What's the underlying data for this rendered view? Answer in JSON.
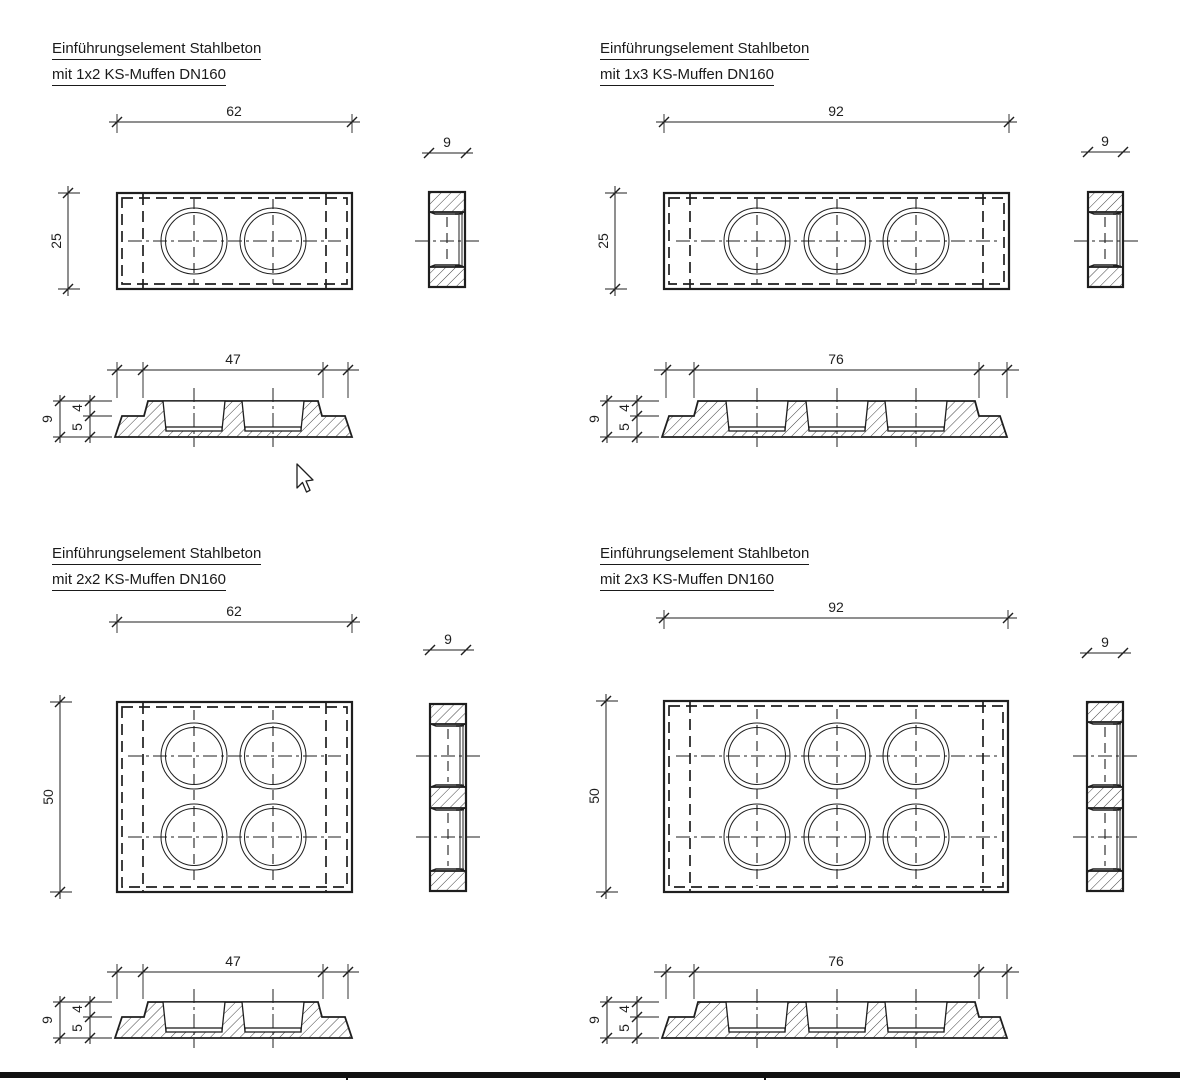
{
  "titles": {
    "tl1": "Einführungselement Stahlbeton",
    "tl2": "mit 1x2 KS-Muffen DN160",
    "tr1": "Einführungselement Stahlbeton",
    "tr2": "mit 1x3 KS-Muffen DN160",
    "bl1": "Einführungselement Stahlbeton",
    "bl2": "mit 2x2 KS-Muffen DN160",
    "br1": "Einführungselement Stahlbeton",
    "br2": "mit 2x3 KS-Muffen DN160"
  },
  "dims": {
    "tl": {
      "plan_w": "62",
      "plan_h": "25",
      "side_w": "9",
      "sec_w": "47",
      "sec_h": "9",
      "sec_top": "4",
      "sec_bottom": "5"
    },
    "tr": {
      "plan_w": "92",
      "plan_h": "25",
      "side_w": "9",
      "sec_w": "76",
      "sec_h": "9",
      "sec_top": "4",
      "sec_bottom": "5"
    },
    "bl": {
      "plan_w": "62",
      "plan_h": "50",
      "side_w": "9",
      "sec_w": "47",
      "sec_h": "9",
      "sec_top": "4",
      "sec_bottom": "5"
    },
    "br": {
      "plan_w": "92",
      "plan_h": "50",
      "side_w": "9",
      "sec_w": "76",
      "sec_h": "9",
      "sec_top": "4",
      "sec_bottom": "5"
    }
  },
  "colors": {
    "line": "#1f1f1f",
    "background": "#ffffff",
    "frame_bar": "#111111"
  }
}
